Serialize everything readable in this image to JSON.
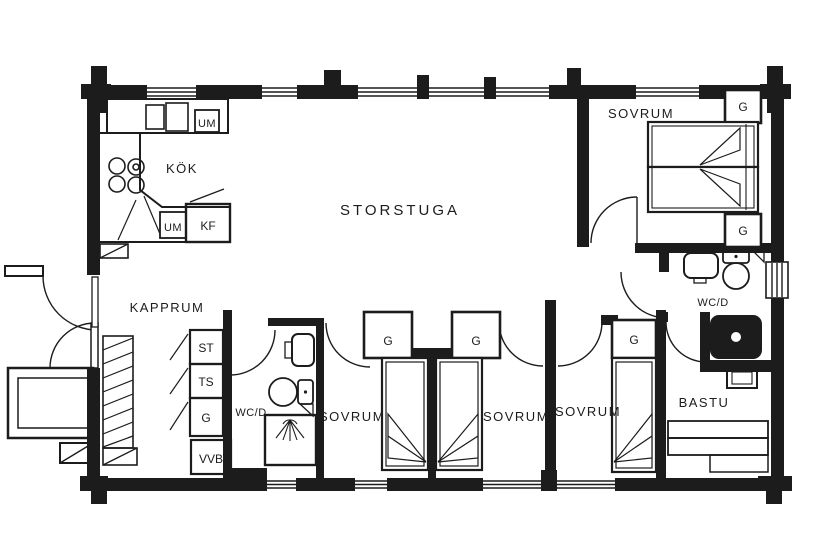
{
  "rooms": {
    "storstuga": "STORSTUGA",
    "kok": "KÖK",
    "kapprum": "KAPPRUM",
    "sovrum_ne": "SOVRUM",
    "sovrum_a": "SOVRUM",
    "sovrum_b": "SOVRUM",
    "sovrum_c": "SOVRUM",
    "wcd_left": "WC/D",
    "wcd_right": "WC/D",
    "bastu": "BASTU"
  },
  "cabinets": {
    "st": "ST",
    "ts": "TS",
    "g_kapprum": "G",
    "vvb": "VVB"
  },
  "closets": {
    "g_a": "G",
    "g_b": "G",
    "g_c": "G",
    "g_ne_top": "G",
    "g_ne_bottom": "G"
  },
  "appliances": {
    "kf": "KF",
    "um_upper": "UM",
    "um_lower": "UM"
  },
  "colors": {
    "ink": "#1c1c1c",
    "paper": "#ffffff"
  }
}
